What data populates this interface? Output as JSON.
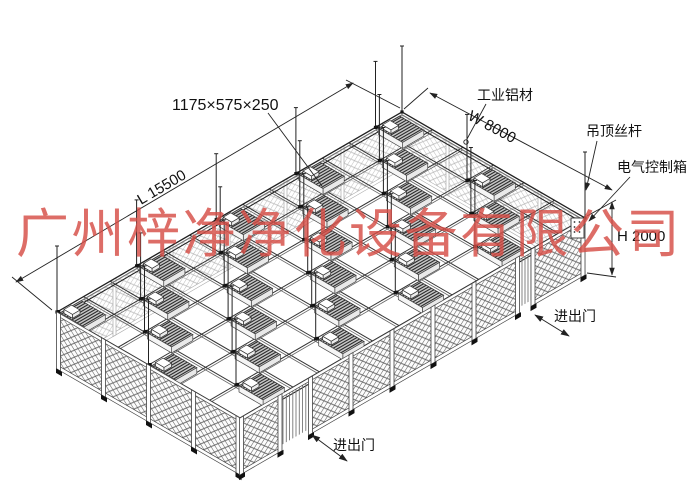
{
  "drawing": {
    "watermark": "广州梓净净化设备有限公司",
    "dimensions": {
      "ffu_size": "1175×575×250",
      "length": "L 15500",
      "width": "W 8000",
      "height": "H 2000"
    },
    "labels": {
      "aluminum_profile": "工业铝材",
      "ceiling_rod": "吊顶丝杆",
      "electric_control_box": "电气控制箱",
      "door_right": "进出门",
      "door_bottom": "进出门"
    },
    "colors": {
      "watermark_red": "#d54d46",
      "line": "#222222"
    }
  }
}
